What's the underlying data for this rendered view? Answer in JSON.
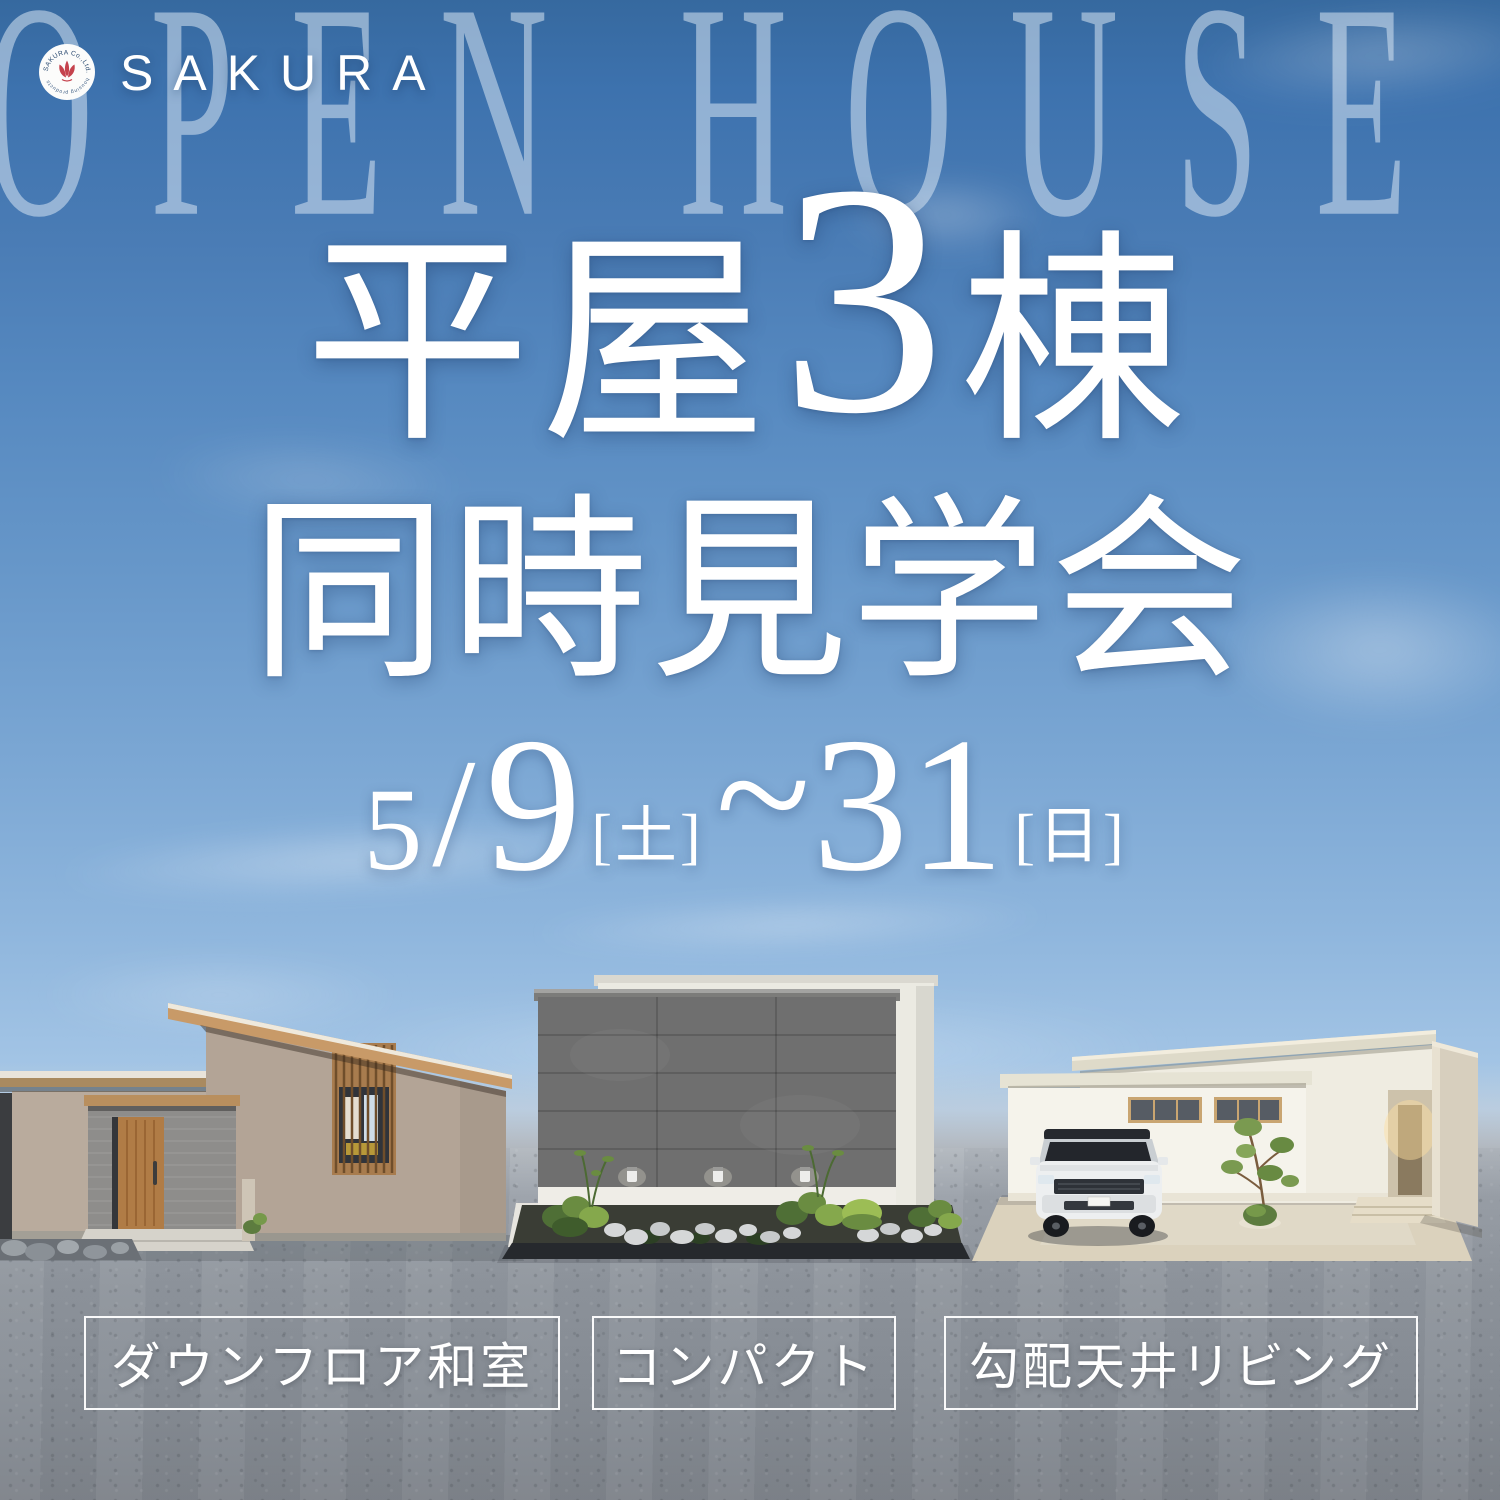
{
  "poster": {
    "watermark_text": "OPEN HOUSE",
    "logo": {
      "company": "SAKURA",
      "badge_top_arc": "SAKURA Co.,Ltd.",
      "badge_bottom_arc": "housing products"
    },
    "title": {
      "line1_pre": "平屋",
      "line1_num": "3",
      "line1_post": "棟",
      "line2": "同時見学会"
    },
    "date": {
      "month": "5",
      "slash": "/",
      "start_day": "9",
      "start_dow": "[土]",
      "tilde": "~",
      "end_day": "31",
      "end_dow": "[日]"
    },
    "features": [
      {
        "label": "ダウンフロア和室"
      },
      {
        "label": "コンパクト"
      },
      {
        "label": "勾配天井リビング"
      }
    ],
    "houses": [
      {
        "name": "shed-roof-house"
      },
      {
        "name": "gray-box-house"
      },
      {
        "name": "white-mono-pitch-house"
      }
    ],
    "colors": {
      "sky_top": "#36699f",
      "sky_light": "#c6d8ec",
      "ground": "#8f959d",
      "accent_red": "#c5424d",
      "text_white": "#ffffff"
    }
  }
}
